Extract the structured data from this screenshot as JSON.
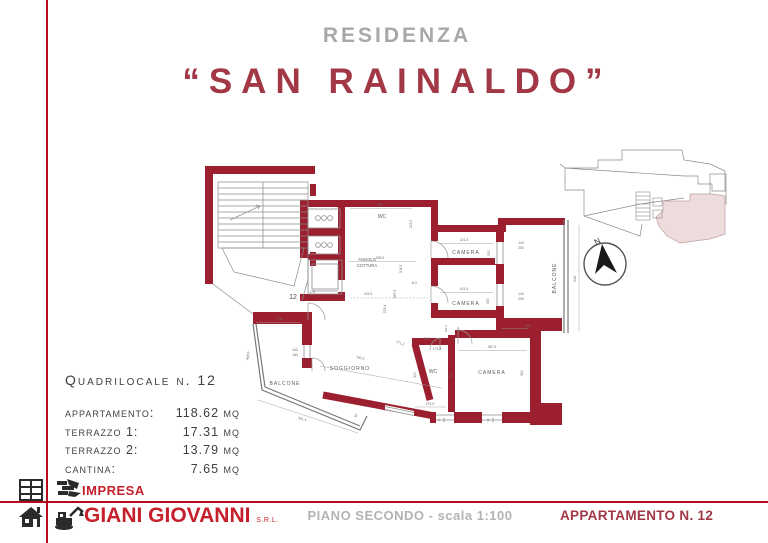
{
  "page": {
    "subtitle": "RESIDENZA",
    "title": "“SAN RAINALDO”"
  },
  "info": {
    "heading": "Quadrilocale n. 12",
    "rows": [
      {
        "label": "appartamento:",
        "value": "118.62 mq"
      },
      {
        "label": "terrazzo 1:",
        "value": "17.31 mq"
      },
      {
        "label": "terrazzo 2:",
        "value": "13.79 mq"
      },
      {
        "label": "cantina:",
        "value": "7.65 mq"
      }
    ]
  },
  "plan": {
    "unit_number": "12",
    "wall_color": "#9b1f2e",
    "labels": [
      {
        "t": "WC",
        "x": 192,
        "y": 70,
        "s": 5
      },
      {
        "t": "ANGOLO",
        "x": 177,
        "y": 113,
        "s": 4.2
      },
      {
        "t": "COTTURA",
        "x": 177,
        "y": 119,
        "s": 4.2
      },
      {
        "t": "CAMERA",
        "x": 276,
        "y": 106,
        "s": 5,
        "ls": 1
      },
      {
        "t": "CAMERA",
        "x": 276,
        "y": 157,
        "s": 5,
        "ls": 1
      },
      {
        "t": "CAMERA",
        "x": 302,
        "y": 226,
        "s": 5,
        "ls": 1
      },
      {
        "t": "SOGGIORNO",
        "x": 160,
        "y": 222,
        "s": 5,
        "ls": 1
      },
      {
        "t": "WC",
        "x": 243,
        "y": 225,
        "s": 5
      },
      {
        "t": "BALCONE",
        "x": 366,
        "y": 130,
        "s": 5,
        "r": -90,
        "ls": 1
      },
      {
        "t": "BALCONE",
        "x": 95,
        "y": 237,
        "s": 5,
        "ls": 1
      },
      {
        "t": "12",
        "x": 103,
        "y": 151,
        "s": 7,
        "c": "#4a4a4a"
      },
      {
        "t": "320",
        "x": 190,
        "y": 57.5
      },
      {
        "t": "215.5",
        "x": 222,
        "y": 76,
        "r": -90
      },
      {
        "t": "265.5",
        "x": 190,
        "y": 111
      },
      {
        "t": "304.5",
        "x": 212,
        "y": 121,
        "r": -90
      },
      {
        "t": "215.5",
        "x": 178,
        "y": 147
      },
      {
        "t": "178",
        "x": 122,
        "y": 145
      },
      {
        "t": "110",
        "x": 224,
        "y": 136
      },
      {
        "t": "497.5",
        "x": 206,
        "y": 146,
        "r": -90
      },
      {
        "t": "278.4",
        "x": 196,
        "y": 161,
        "r": -90
      },
      {
        "t": "421.5",
        "x": 274,
        "y": 93
      },
      {
        "t": "350",
        "x": 300,
        "y": 105,
        "r": -90
      },
      {
        "t": "140",
        "x": 331,
        "y": 96
      },
      {
        "t": "250",
        "x": 331,
        "y": 101
      },
      {
        "t": "421.5",
        "x": 274,
        "y": 142
      },
      {
        "t": "350",
        "x": 299,
        "y": 153,
        "r": -90
      },
      {
        "t": "140",
        "x": 331,
        "y": 147
      },
      {
        "t": "250",
        "x": 331,
        "y": 152
      },
      {
        "t": "544",
        "x": 386,
        "y": 131,
        "r": -90
      },
      {
        "t": "250",
        "x": 338,
        "y": 179
      },
      {
        "t": "387.5",
        "x": 302,
        "y": 200
      },
      {
        "t": "360",
        "x": 333,
        "y": 225,
        "r": -90
      },
      {
        "t": "302",
        "x": 237,
        "y": 192
      },
      {
        "t": "173.4",
        "x": 247,
        "y": 202
      },
      {
        "t": "300",
        "x": 226,
        "y": 227,
        "r": -90
      },
      {
        "t": "202",
        "x": 262,
        "y": 227,
        "r": -90
      },
      {
        "t": "274.9",
        "x": 240,
        "y": 257
      },
      {
        "t": "169.3",
        "x": 257,
        "y": 181,
        "r": -90,
        "s": 2.8
      },
      {
        "t": "110",
        "x": 269,
        "y": 181,
        "r": -90,
        "s": 2.8
      },
      {
        "t": "271.2",
        "x": 210,
        "y": 196,
        "r": 22
      },
      {
        "t": "780.5",
        "x": 170,
        "y": 211,
        "r": 10
      },
      {
        "t": "230",
        "x": 90,
        "y": 172
      },
      {
        "t": "448.5",
        "x": 59,
        "y": 208,
        "r": -84
      },
      {
        "t": "140",
        "x": 105,
        "y": 203
      },
      {
        "t": "180",
        "x": 105,
        "y": 208
      },
      {
        "t": "561.4",
        "x": 112,
        "y": 272,
        "r": 14
      },
      {
        "t": "50",
        "x": 167,
        "y": 268,
        "r": -70
      },
      {
        "t": "70",
        "x": 250,
        "y": 272,
        "r": -90,
        "s": 2.8
      },
      {
        "t": "140",
        "x": 255,
        "y": 272,
        "r": -90,
        "s": 2.8
      },
      {
        "t": "90",
        "x": 299,
        "y": 272,
        "r": -90,
        "s": 2.8
      },
      {
        "t": "150",
        "x": 304,
        "y": 272,
        "r": -90,
        "s": 2.8
      }
    ]
  },
  "minimap": {
    "highlight_color": "#eedcdc"
  },
  "compass": {
    "label": "N"
  },
  "footer": {
    "impresa": "IMPRESA",
    "company": "GIANI GIOVANNI",
    "company_suffix": "S.R.L.",
    "center": "PIANO SECONDO - scala 1:100",
    "right": "APPARTAMENTO N. 12"
  }
}
